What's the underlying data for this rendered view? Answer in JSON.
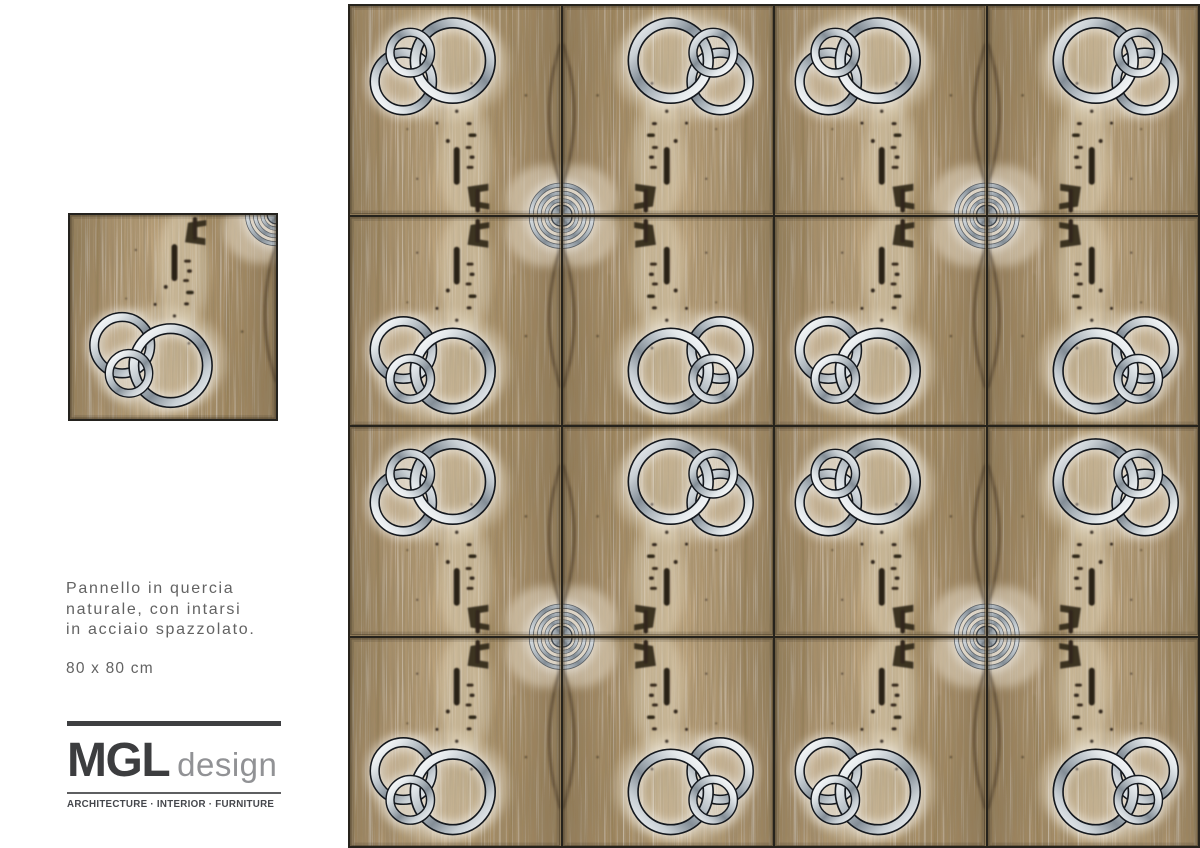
{
  "page": {
    "background": "#ffffff"
  },
  "sidebar": {
    "description_lines": [
      "Pannello in quercia",
      "naturale, con intarsi",
      "in acciaio spazzolato."
    ],
    "size_label": "80 x 80 cm",
    "logo": {
      "name": "MGL",
      "suffix": "design",
      "tagline": "ARCHITECTURE · INTERIOR · FURNITURE"
    }
  },
  "panel_preview": {
    "motifs": [
      "interlocking-steel-rings",
      "concentric-steel-target-corner",
      "oak-knots-and-cracks"
    ]
  },
  "panel_grid": {
    "rows": 4,
    "cols": 4,
    "arrangement": "book-matched mirrored tiles (each 2x2 block symmetric, target motif at block centers, ring clusters at block corners)",
    "colors": {
      "oak_base": "#b0976f",
      "oak_light": "#cdb68d",
      "oak_dark": "#6d5a3f",
      "knot_dark": "#33281a",
      "steel_light": "#f2f4f6",
      "steel_dark": "#87919a",
      "ring_outline": "#14181e",
      "seam": "#26231c"
    }
  }
}
